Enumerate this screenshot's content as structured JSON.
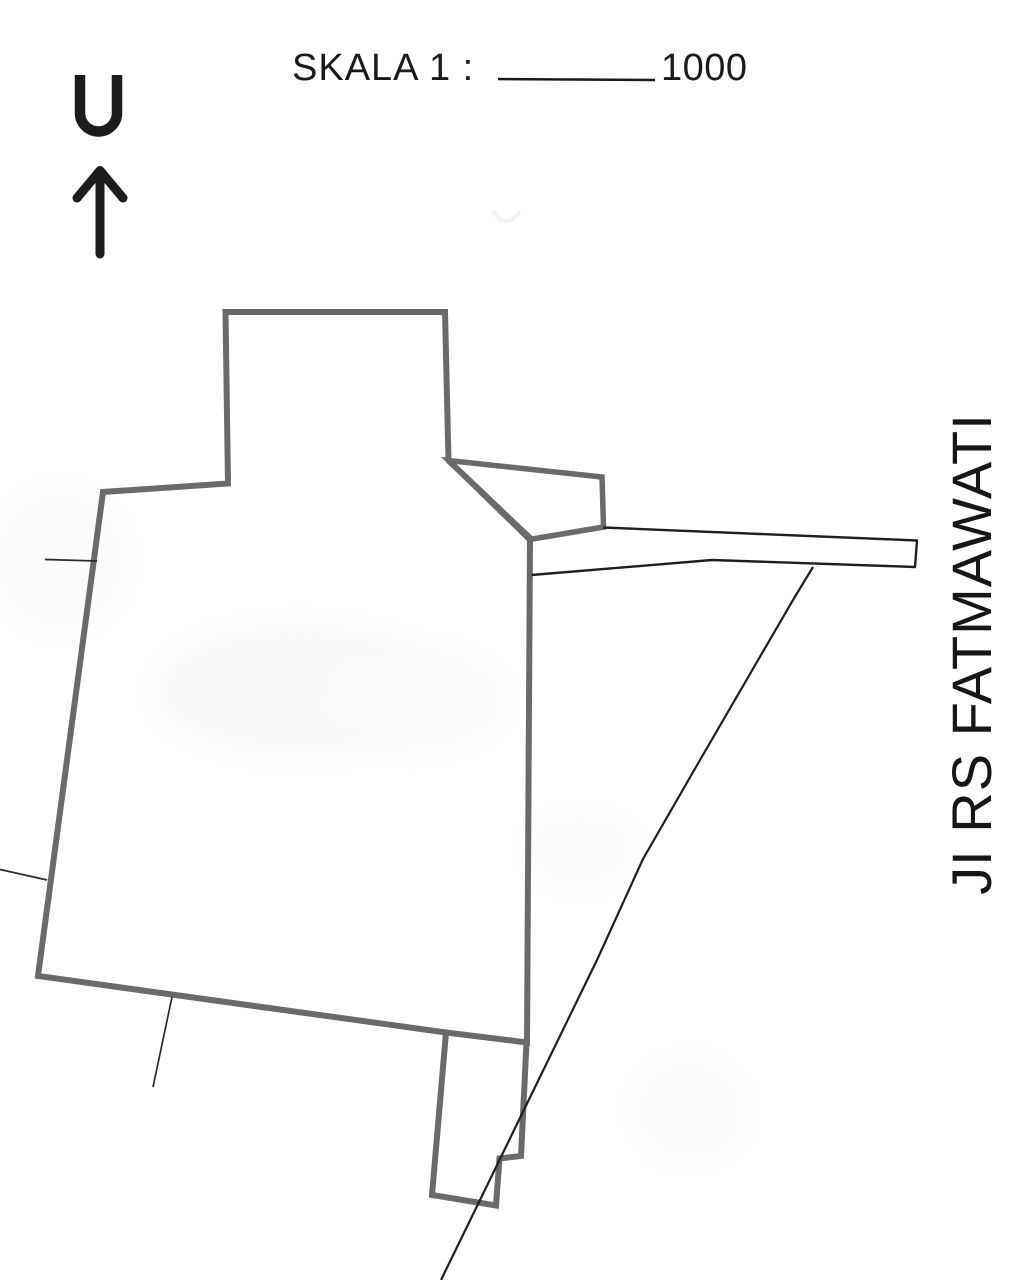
{
  "scale": {
    "prefix": "SKALA 1 :",
    "value": "1000"
  },
  "north_indicator": {
    "letter": "U"
  },
  "street": {
    "label": "JI RS FATMAWATI"
  },
  "colors": {
    "parcel_outline": "#6a6a6a",
    "thin_line": "#1f1f1f",
    "leader_line": "#2a2a2a",
    "text": "#1a1a1a",
    "north_glyph": "#1c1c1c",
    "background": "#ffffff",
    "smudge": "#f4f4f4"
  },
  "geometry": {
    "parcel_main": "M 225.5 312 L 445 312 L 448.5 460.5 L 530 538 L 527 1042.5 L 446 1032.5 L 38 976 L 103 492 L 228 483.5 Z",
    "parcel_annex": "M 446 1032.5 L 432 1195 L 496 1205.5 L 499.5 1158.5 L 521 1156 L 526.5 1042.5",
    "access_trapezoid": "M 448.5 460.5 L 602 477 L 603.5 527 L 529.5 539.5 Z",
    "road_strip": "M 603.5 527.5 L 917 540.5 L 915 567 L 712 560 L 531.5 575",
    "road_diagonal": "M 813 567 L 793 600 L 700 760 L 643 859 L 597 960 L 441 1280",
    "leader_west": "M 45 559.5 L 97 561",
    "leader_southwest": "M 0 869.5 L 47 880",
    "leader_south": "M 172 997 L 153 1087",
    "north_letter_path": "M 80 75 L 80 113 A 18.5 18.5 0 0 0 117 113 L 117 75",
    "north_arrow_shaft": "M 100 254 L 100 173",
    "north_arrow_head": "M 77 198 L 100 170.5 L 123 198",
    "smudge_arc": "M 494 212 Q 504 230 519 213"
  }
}
